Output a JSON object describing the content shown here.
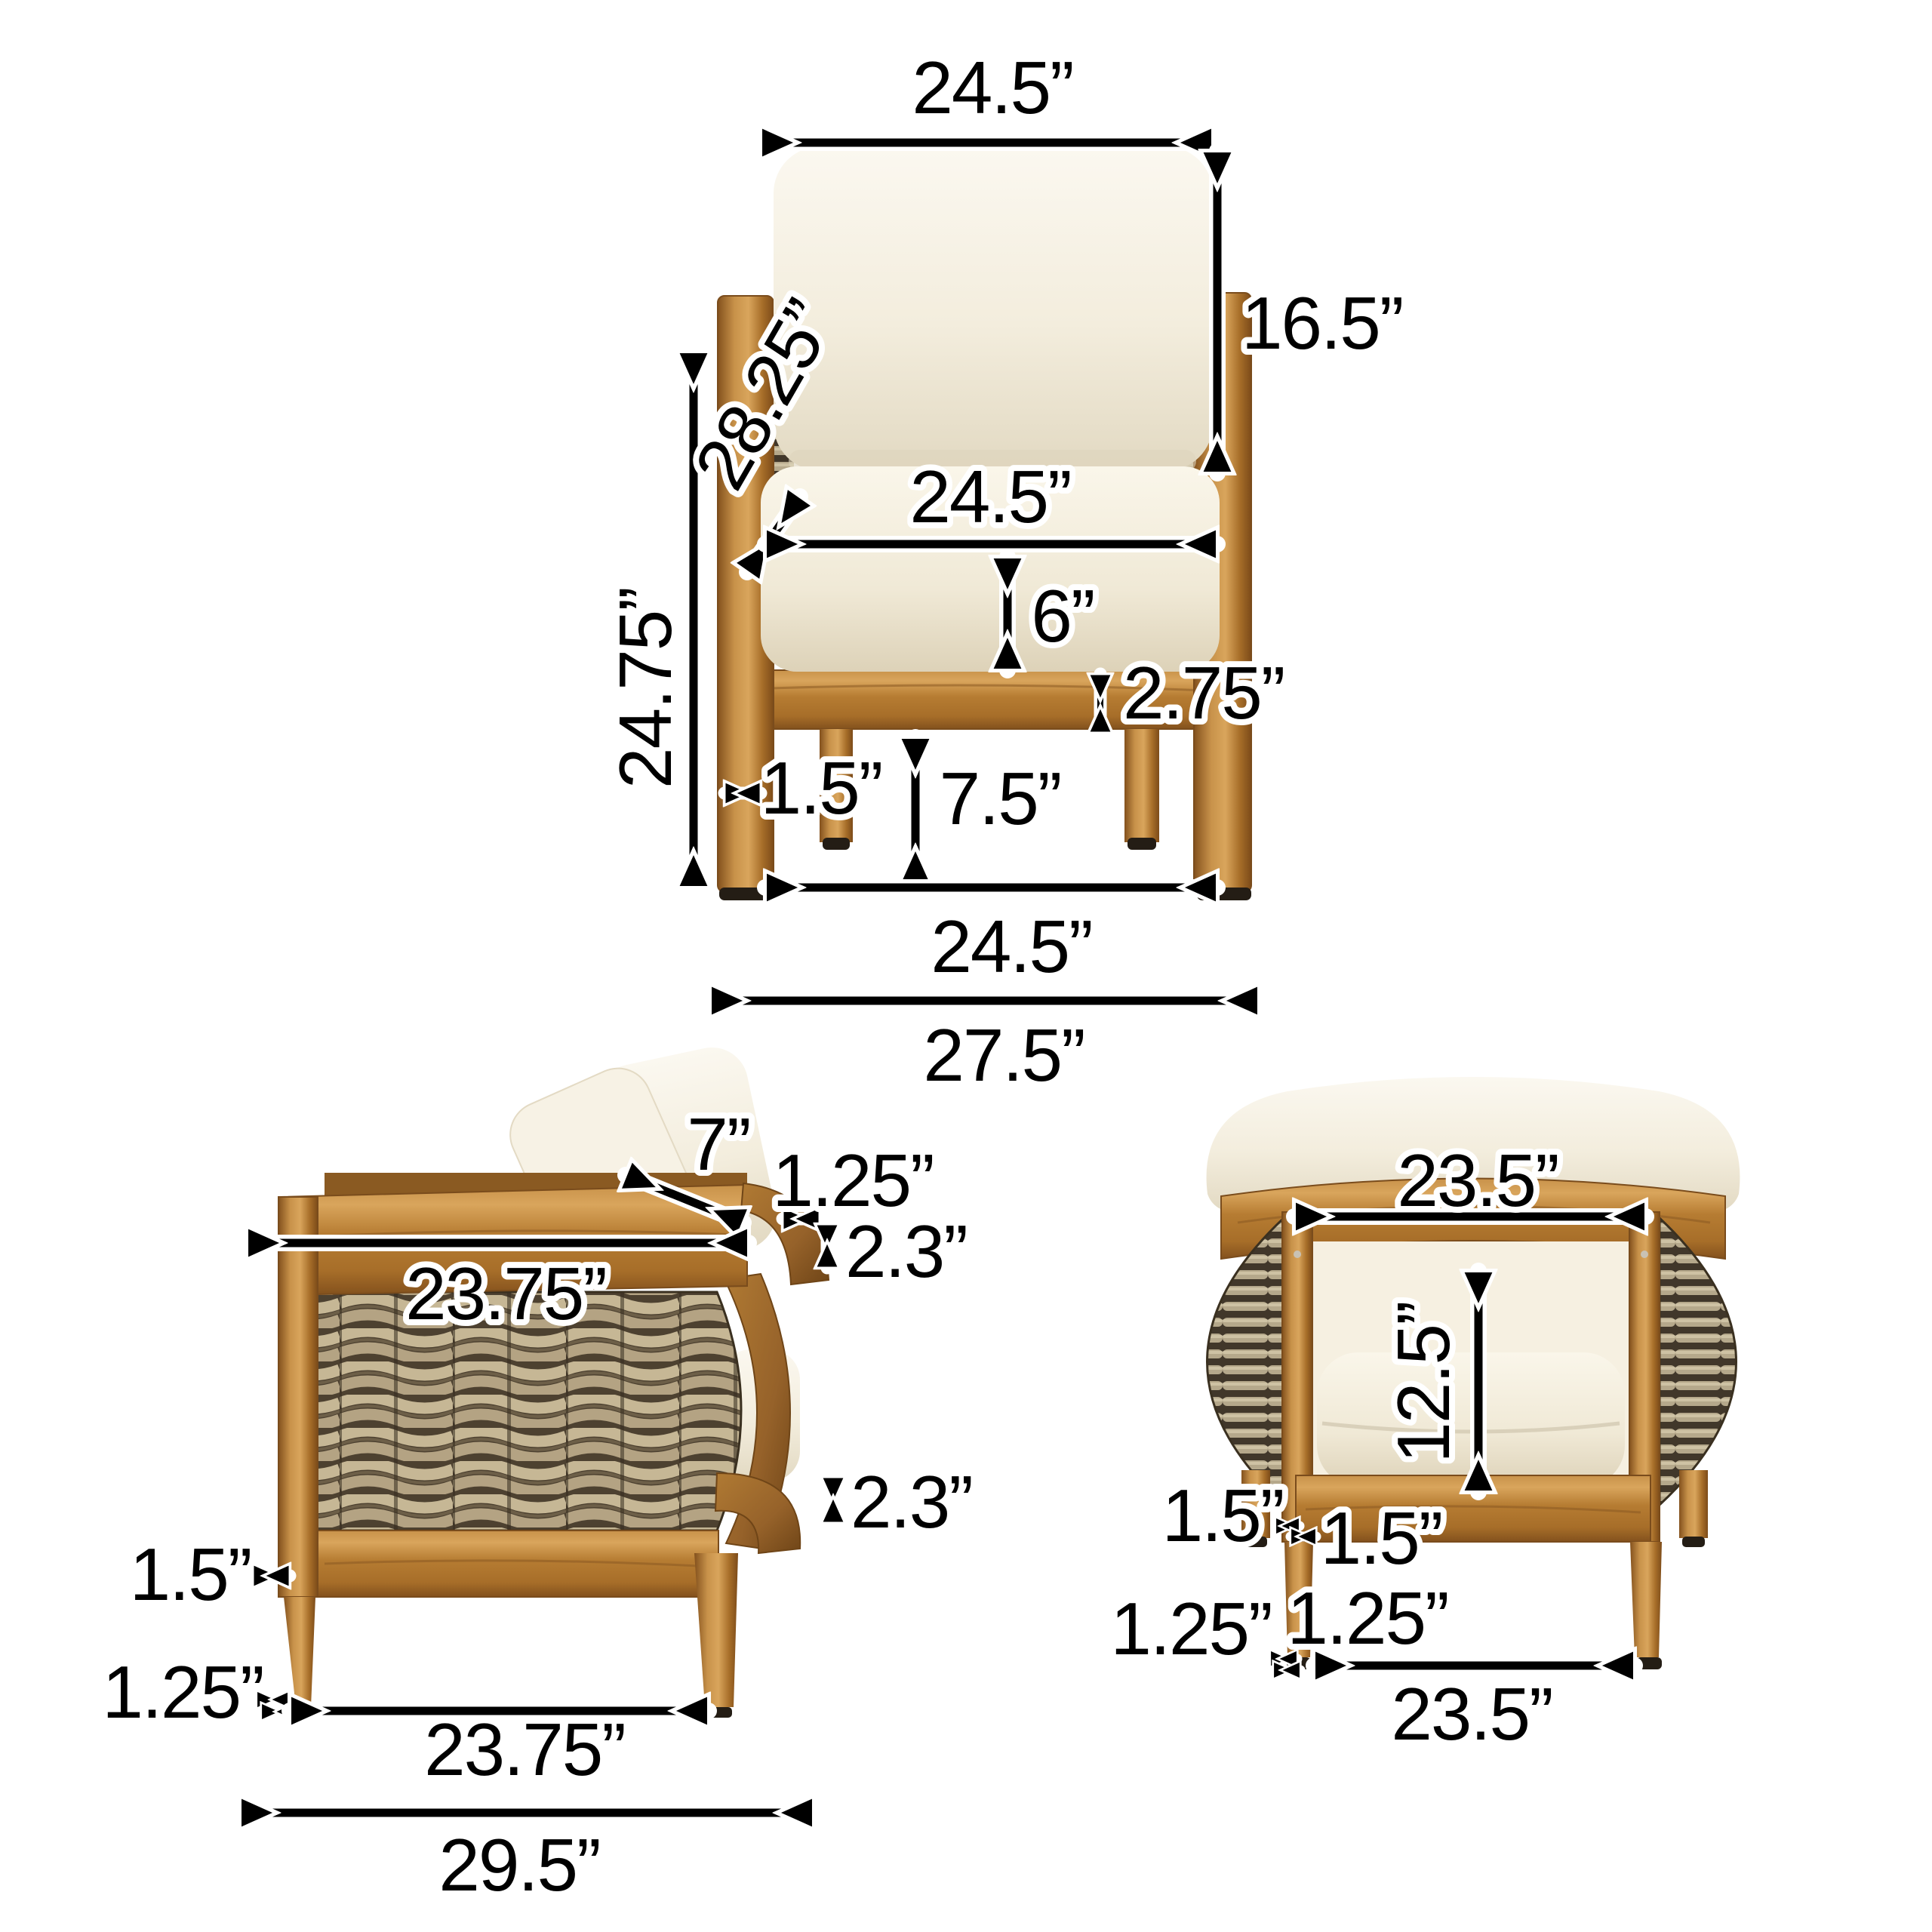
{
  "diagram": {
    "background": "#ffffff",
    "colors": {
      "wood_light": "#d9a55c",
      "wood": "#b67c32",
      "wood_dark": "#83511d",
      "wicker": "#b5a88b",
      "wicker_gap": "#4d4130",
      "cushion": "#f3eddd",
      "foot": "#241d15",
      "dimension_line": "#000000",
      "label_fill": "#000000",
      "label_outline": "#ffffff"
    },
    "views": {
      "front": {
        "dims": {
          "back_cushion_width": "24.5”",
          "back_cushion_height": "16.5”",
          "back_height_diagonal": "28.25”",
          "side_frame_height": "24.75”",
          "seat_cushion_width": "24.5”",
          "seat_cushion_thickness": "6”",
          "seat_rail_height": "2.75”",
          "leg_width": "1.5”",
          "under_seat_clearance": "7.5”",
          "inner_leg_span": "24.5”",
          "overall_width": "27.5”"
        }
      },
      "side": {
        "dims": {
          "pillow_depth": "7”",
          "arm_rail_thickness": "1.25”",
          "back_rail_top_height": "2.3”",
          "arm_depth": "23.75”",
          "back_rail_bottom_height": "2.3”",
          "leg_width": "1.5”",
          "foot_width": "1.25”",
          "leg_span_depth": "23.75”",
          "overall_depth": "29.5”"
        }
      },
      "back": {
        "dims": {
          "back_width": "23.5”",
          "back_opening_height": "12.5”",
          "leg_width_outer": "1.5”",
          "leg_width_inner": "1.5”",
          "foot_width_outer": "1.25”",
          "foot_width_inner": "1.25”",
          "leg_span_width": "23.5”"
        }
      }
    }
  }
}
